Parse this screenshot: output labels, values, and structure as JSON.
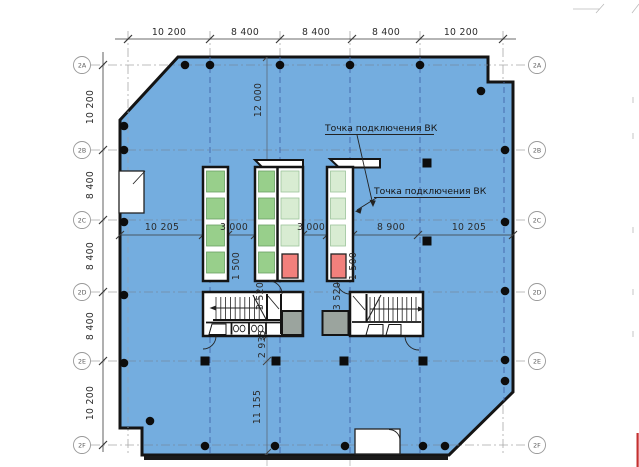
{
  "drawing_type": "architectural-floor-plan",
  "annotations": {
    "note1": "Точка подключения ВК",
    "note2": "Точка подключения ВК"
  },
  "grid_rows": [
    {
      "label": "2A"
    },
    {
      "label": "2B"
    },
    {
      "label": "2C"
    },
    {
      "label": "2D"
    },
    {
      "label": "2E"
    },
    {
      "label": "2F"
    }
  ],
  "dims": {
    "top": [
      "10 200",
      "8 400",
      "8 400",
      "8 400",
      "10 200"
    ],
    "left": [
      "10 200",
      "8 400",
      "8 400",
      "8 400",
      "10 200"
    ],
    "middle": [
      "10 205",
      "3 000",
      "3 000",
      "8 900",
      "10 205"
    ],
    "vertical": [
      "12 000",
      "1 500",
      "1 500",
      "3 520",
      "3 520",
      "2 935",
      "11 155"
    ]
  },
  "colors": {
    "floor_blue": "#74addf",
    "wall_black": "#141414",
    "cell_green": "#98cf8b",
    "cell_pale_green": "#d8ecd2",
    "cell_red": "#f2807c",
    "shaft_gray": "#9ba49e",
    "grid_navy_dash": "#4466aa",
    "edge_red_line": "#c53030"
  }
}
